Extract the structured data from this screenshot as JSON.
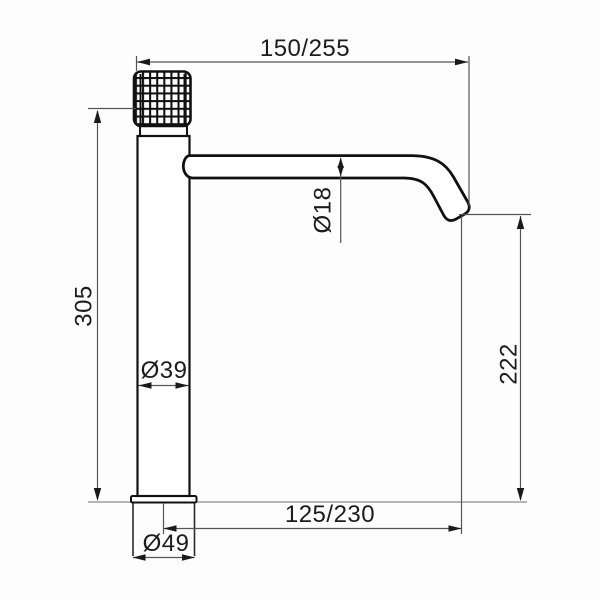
{
  "drawing": {
    "type": "technical-dimension-drawing",
    "subject": "tall single-lever basin mixer tap, side view",
    "dimensions": {
      "spout_reach_top": "150/255",
      "body_height": "305",
      "spout_tube_diameter": "Ø18",
      "outlet_height": "222",
      "outlet_reach_bottom": "125/230",
      "body_diameter": "Ø39",
      "base_diameter": "Ø49"
    },
    "colors": {
      "background": "#fdfdfd",
      "object_line": "#111111",
      "dimension_line": "#555555",
      "arrow": "#1a1a1a",
      "text": "#1c1c1c"
    }
  }
}
